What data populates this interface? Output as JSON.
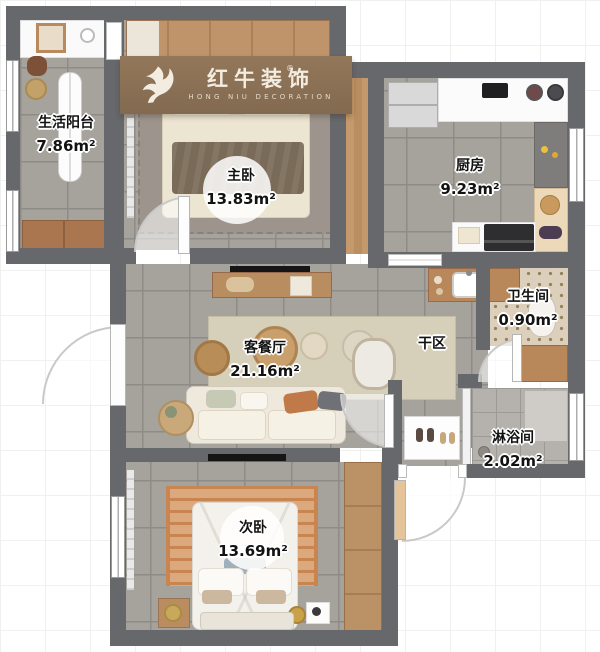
{
  "brand": {
    "name": "红牛装饰",
    "subtitle": "HONG NIU DECORATION",
    "registered_mark": "®"
  },
  "rooms": [
    {
      "name": "生活阳台",
      "area": "7.86m²"
    },
    {
      "name": "主卧",
      "area": "13.83m²"
    },
    {
      "name": "厨房",
      "area": "9.23m²"
    },
    {
      "name": "卫生间",
      "area": "0.90m²"
    },
    {
      "name": "客餐厅",
      "area": "21.16m²"
    },
    {
      "name": "干区",
      "area": ""
    },
    {
      "name": "淋浴间",
      "area": "2.02m²"
    },
    {
      "name": "次卧",
      "area": "13.69m²"
    }
  ],
  "colors": {
    "wall": "#67686c",
    "tile_floor": "#a6a29c",
    "wood": "#bb9166",
    "banner": "#8c7156",
    "living_rug": "#d6cfba",
    "bedroom_rug": "#dca87e",
    "label_text": "#121212"
  }
}
